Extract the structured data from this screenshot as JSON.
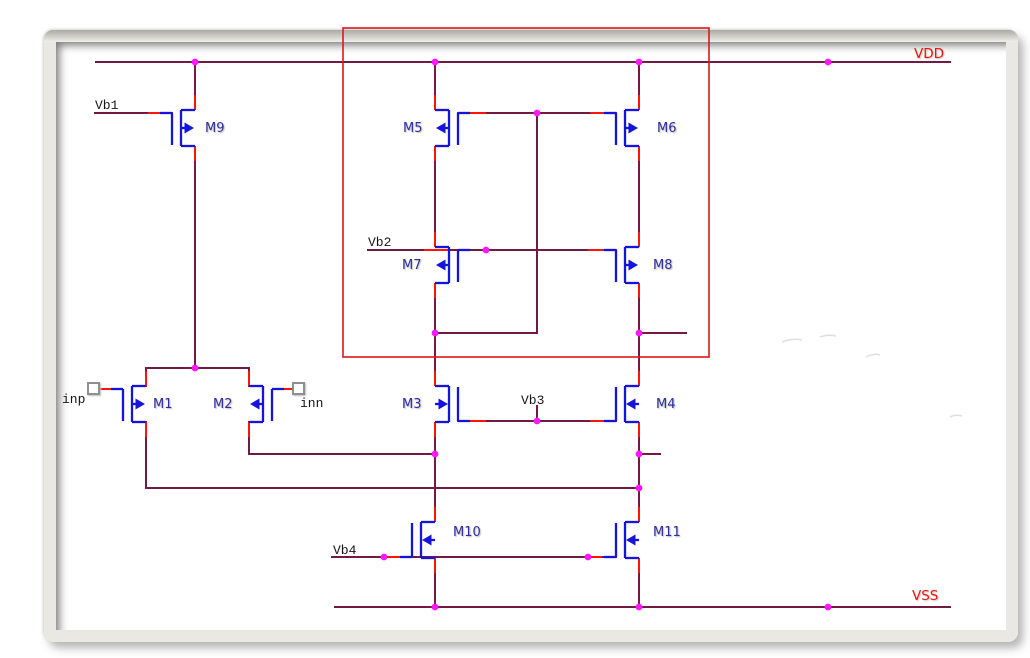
{
  "schematic": {
    "rails": {
      "vdd": "VDD",
      "vss": "VSS"
    },
    "transistors": [
      {
        "name": "M1"
      },
      {
        "name": "M2"
      },
      {
        "name": "M3"
      },
      {
        "name": "M4"
      },
      {
        "name": "M5"
      },
      {
        "name": "M6"
      },
      {
        "name": "M7"
      },
      {
        "name": "M8"
      },
      {
        "name": "M9"
      },
      {
        "name": "M10"
      },
      {
        "name": "M11"
      }
    ],
    "bias_labels": {
      "vb1": "Vb1",
      "vb2": "Vb2",
      "vb3": "Vb3",
      "vb4": "Vb4"
    },
    "input_ports": {
      "inp": "inp",
      "inn": "inn"
    },
    "colors": {
      "wire": "#721a44",
      "terminal": "#ff1405",
      "device": "#1414dd",
      "junction": "#ff18ff",
      "highlight_box": "#e01717",
      "rail_label": "#e8150d",
      "device_label": "#2d2da2",
      "net_label": "#161616"
    }
  }
}
